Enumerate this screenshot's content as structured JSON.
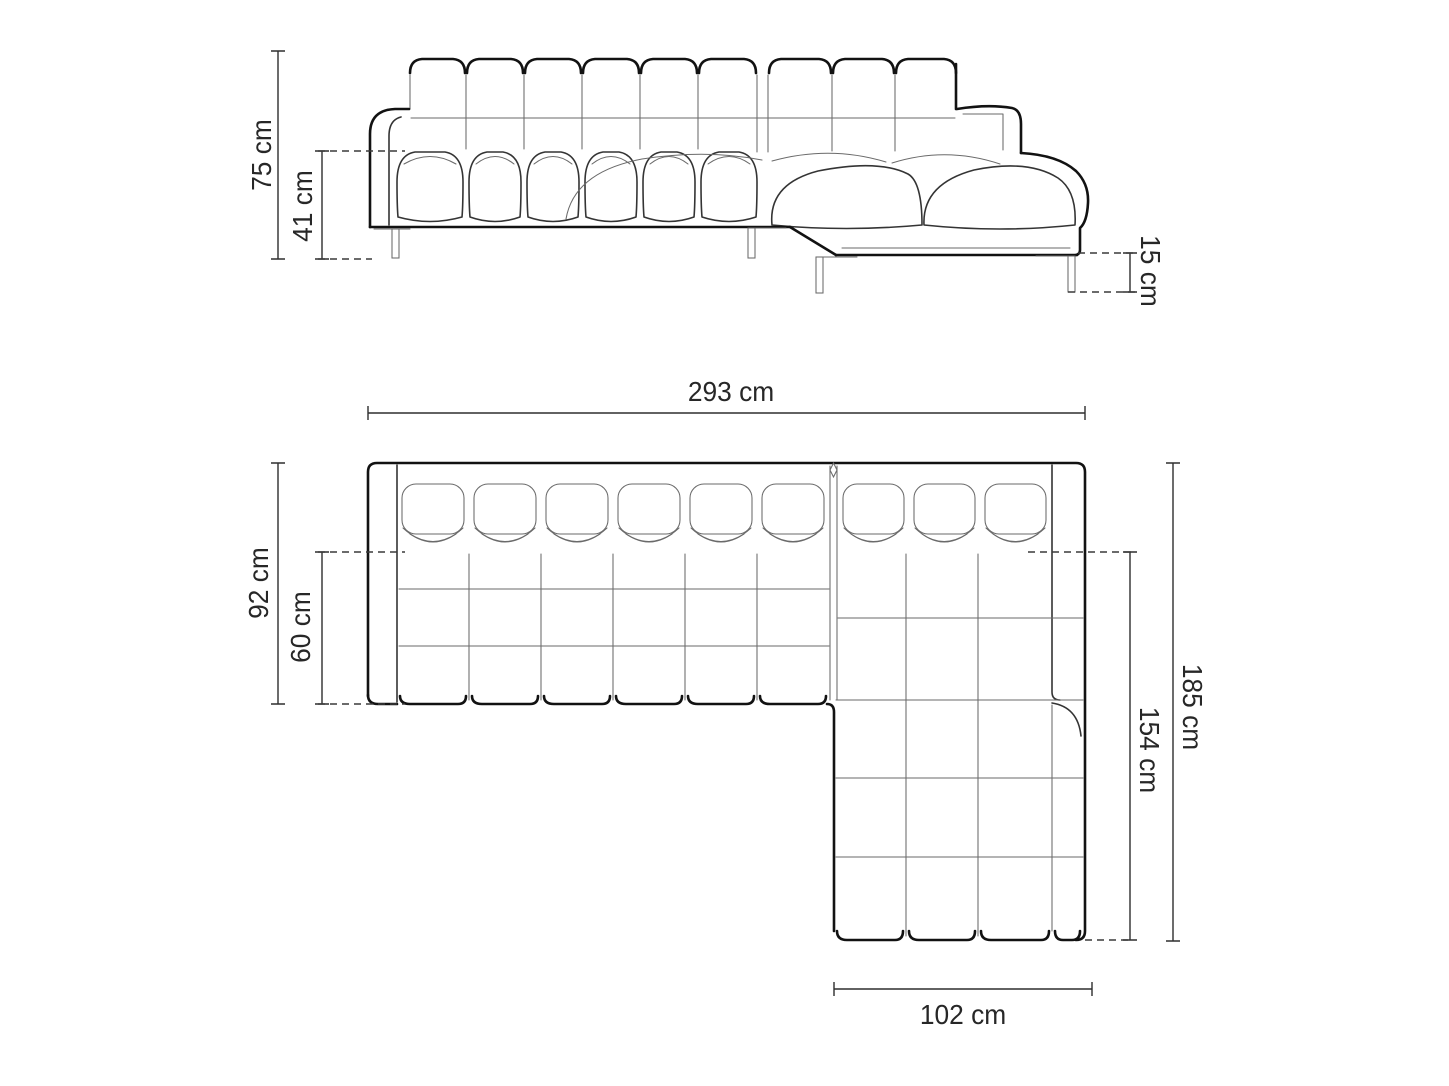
{
  "drawing": {
    "type": "furniture-dimension-diagram",
    "subject": "corner-sofa-with-chaise",
    "background": "#ffffff",
    "colors": {
      "outline": "#121212",
      "detail_line": "#6a6a6a",
      "dimension_line": "#2e2e2e",
      "text": "#272727"
    },
    "views": {
      "front": {
        "name": "front-elevation",
        "dimensions": [
          {
            "id": "total_height",
            "label": "75 cm",
            "value": 75,
            "unit": "cm",
            "orientation": "vertical"
          },
          {
            "id": "seat_height",
            "label": "41 cm",
            "value": 41,
            "unit": "cm",
            "orientation": "vertical"
          },
          {
            "id": "leg_height",
            "label": "15 cm",
            "value": 15,
            "unit": "cm",
            "orientation": "vertical"
          }
        ]
      },
      "plan": {
        "name": "top-plan",
        "dimensions": [
          {
            "id": "total_width",
            "label": "293 cm",
            "value": 293,
            "unit": "cm",
            "orientation": "horizontal"
          },
          {
            "id": "total_depth",
            "label": "92 cm",
            "value": 92,
            "unit": "cm",
            "orientation": "vertical"
          },
          {
            "id": "seat_depth",
            "label": "60 cm",
            "value": 60,
            "unit": "cm",
            "orientation": "vertical"
          },
          {
            "id": "chaise_total_depth",
            "label": "185 cm",
            "value": 185,
            "unit": "cm",
            "orientation": "vertical"
          },
          {
            "id": "chaise_inner_length",
            "label": "154 cm",
            "value": 154,
            "unit": "cm",
            "orientation": "vertical"
          },
          {
            "id": "chaise_width",
            "label": "102 cm",
            "value": 102,
            "unit": "cm",
            "orientation": "horizontal"
          }
        ]
      }
    }
  }
}
